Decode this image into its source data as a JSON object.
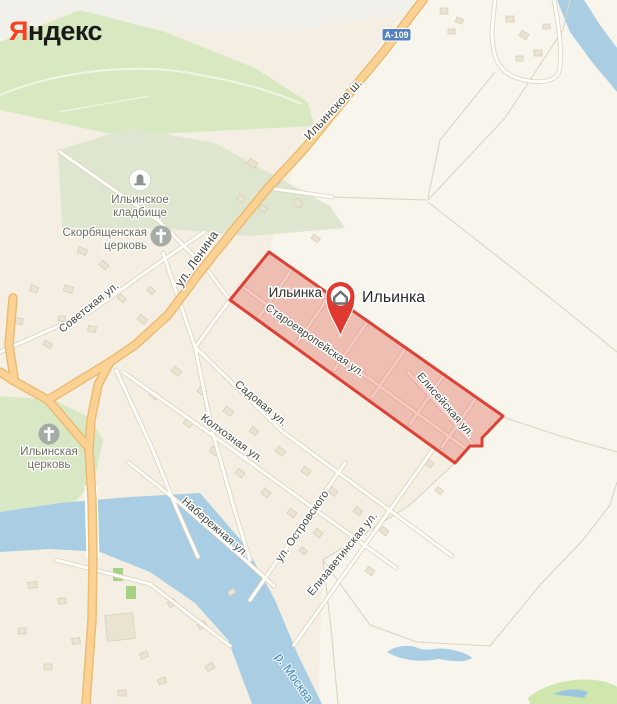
{
  "logo": {
    "first_letter": "Я",
    "rest": "ндекс",
    "first_color": "#fc3f1d",
    "rest_color": "#1a1a1a"
  },
  "highway_badge": {
    "label": "А-109",
    "bg_color": "#5381c1",
    "text_color": "#ffffff"
  },
  "placemark": {
    "label": "Ильинка",
    "pin_color": "#e0392f",
    "icon": "house-icon"
  },
  "settlement_label": "Ильинка",
  "highlighted_area": {
    "name": "Ильинка",
    "fill": "rgba(224,60,49,0.27)",
    "stroke": "#dd4237"
  },
  "streets": [
    {
      "label": "Ильинское ш."
    },
    {
      "label": "ул. Ленина"
    },
    {
      "label": "Советская ул."
    },
    {
      "label": "Староевропейская ул."
    },
    {
      "label": "Елисейская ул."
    },
    {
      "label": "Садовая ул."
    },
    {
      "label": "Колхозная ул."
    },
    {
      "label": "Набережная ул."
    },
    {
      "label": "ул. Островского"
    },
    {
      "label": "Елизаветинская ул."
    }
  ],
  "river": {
    "label": "р. Москва",
    "water_color": "#a9cee4",
    "label_color": "#4788ba"
  },
  "pois": {
    "cemetery": {
      "line1": "Ильинское",
      "line2": "кладбище",
      "icon": "tombstone-icon"
    },
    "skorbyashchenskaya_church": {
      "line1": "Скорбященская",
      "line2": "церковь",
      "icon": "cross-icon"
    },
    "ilyinskaya_church": {
      "line1": "Ильинская",
      "line2": "церковь",
      "icon": "cross-icon"
    }
  },
  "colors": {
    "land": "#f5efe3",
    "field": "#f7f5ec",
    "top_band": "#f1f0ea",
    "forest": "#d8e9c1",
    "cemetery_green": "#dee6cf",
    "park": "#d8e8c4",
    "water": "#a9cee4",
    "building": "#eae3d2",
    "road_orange": "#fbd294",
    "road_orange_casing": "#e9bc74",
    "minor_road": "#fffdf6",
    "minor_road_casing": "#d9d3c5",
    "area_fill": "rgba(224,60,49,0.27)",
    "area_stroke": "#dd4237",
    "pin_red": "#e0392f",
    "badge_blue": "#5381c1",
    "logo_red": "#fc3f1d",
    "street_label": "#45453f",
    "poi_label": "#6e6e60",
    "river_label": "#4788ba"
  }
}
